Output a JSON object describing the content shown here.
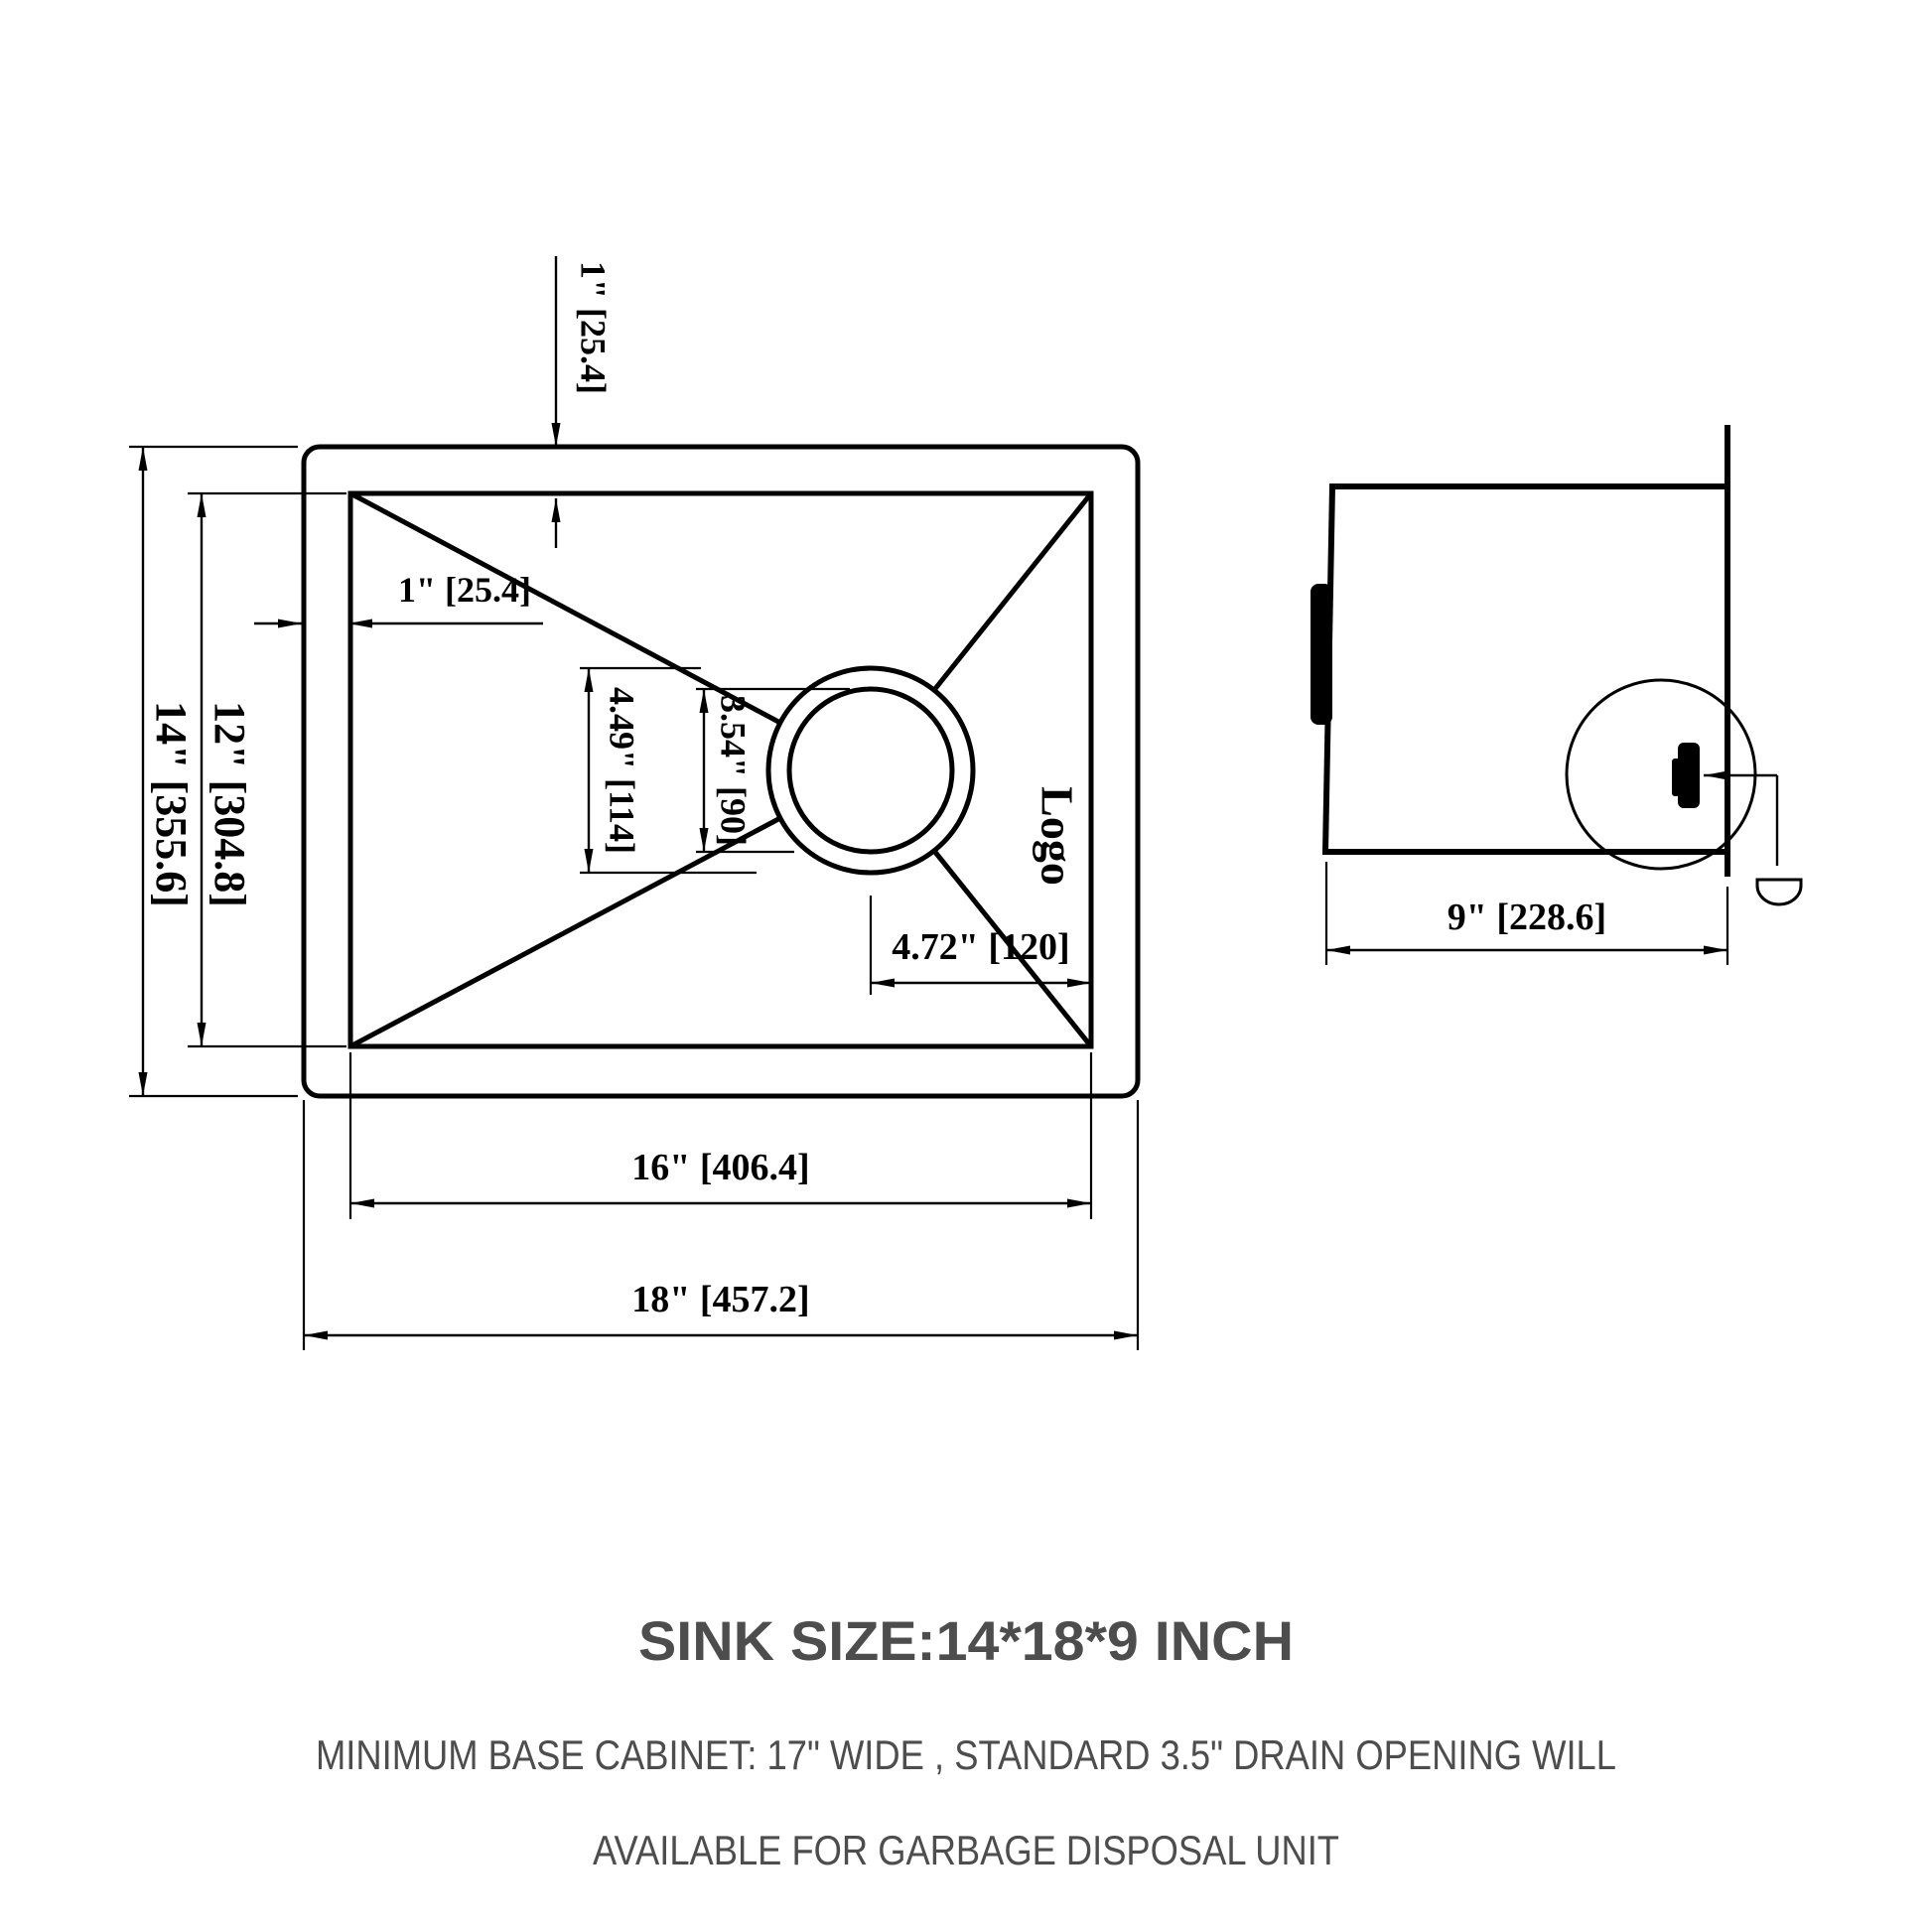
{
  "drawing": {
    "top_view": {
      "dim_top_rim": "1\" [25.4]",
      "dim_left_rim": "1\" [25.4]",
      "dim_outer_height": "14\" [355.6]",
      "dim_inner_height": "12\" [304.8]",
      "dim_drain_flange": "4.49\" [114]",
      "dim_drain_opening": "3.54\" [90]",
      "dim_drain_offset": "4.72\" [120]",
      "dim_inner_width": "16\" [406.4]",
      "dim_outer_width": "18\" [457.2]",
      "logo": "Logo"
    },
    "side_view": {
      "dim_depth": "9\" [228.6]"
    }
  },
  "notes": {
    "title": "SINK SIZE:14*18*9 INCH",
    "line1": "MINIMUM BASE CABINET: 17\" WIDE , STANDARD 3.5\" DRAIN OPENING WILL",
    "line2": "AVAILABLE FOR GARBAGE DISPOSAL UNIT"
  },
  "colors": {
    "line": "#000000",
    "note_text": "#4d4d4d",
    "background": "#ffffff"
  }
}
